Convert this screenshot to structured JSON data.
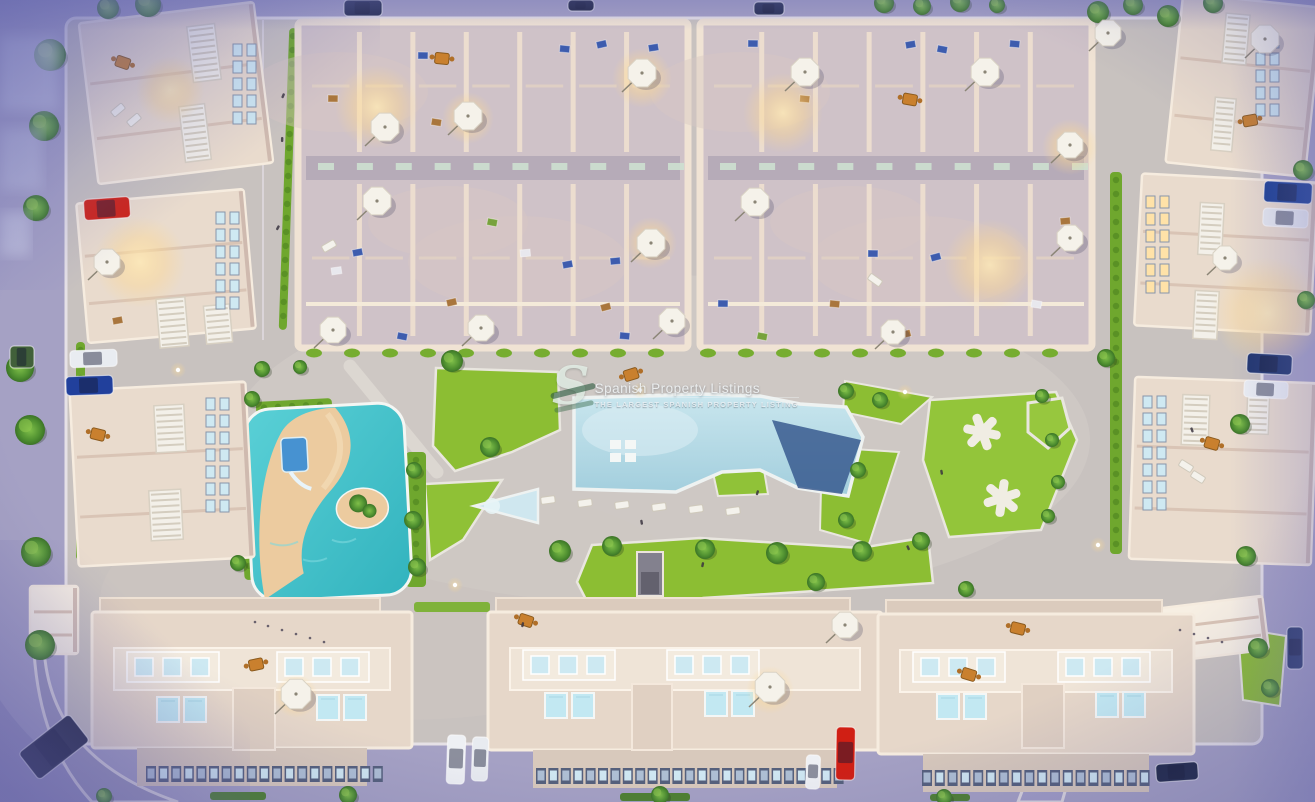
{
  "watermark": {
    "logo": "S",
    "title": "Spanish Property Listings",
    "subtitle": "THE LARGEST SPANISH PROPERTY LISTING"
  },
  "scene": {
    "description": "Aerial dusk render of a residential complex with central pool, lagoon splash park, lawns and perimeter apartment buildings",
    "palette": {
      "street": "#a5a1c4",
      "plaza": "#c8c2bf",
      "plazaLight": "#d4cec9",
      "wall": "#eadcce",
      "wallBright": "#f4e9db",
      "wallShadow": "#c8b2a8",
      "floor": "#cfc2c8",
      "corridor": "#b6abb8",
      "green": "#8cbe33",
      "greenLight": "#a8d44b",
      "hedge": "#6fa72e",
      "pool": "#b5dbe6",
      "poolDeep": "#31528a",
      "lagoon": "#4ac4cc",
      "sand": "#eccb9f",
      "plunge": "#c2e8f2",
      "glow": "#ffd98f",
      "umbrella": "#f5f2ea",
      "louver": "#f3f0e9",
      "carRed": "#cf2318",
      "carBlue": "#21409c",
      "carWhite": "#eceff3",
      "carDark": "#222a4c"
    },
    "trees": [
      [
        50,
        55,
        16
      ],
      [
        44,
        126,
        15
      ],
      [
        36,
        208,
        13
      ],
      [
        20,
        368,
        14
      ],
      [
        30,
        430,
        15
      ],
      [
        36,
        552,
        15
      ],
      [
        40,
        645,
        15
      ],
      [
        148,
        4,
        13
      ],
      [
        108,
        8,
        11
      ],
      [
        262,
        369,
        8
      ],
      [
        300,
        367,
        7
      ],
      [
        452,
        361,
        11
      ],
      [
        490,
        447,
        10
      ],
      [
        560,
        551,
        11
      ],
      [
        612,
        546,
        10
      ],
      [
        705,
        549,
        10
      ],
      [
        777,
        553,
        11
      ],
      [
        816,
        582,
        9
      ],
      [
        862,
        551,
        10
      ],
      [
        921,
        541,
        9
      ],
      [
        966,
        589,
        8
      ],
      [
        414,
        470,
        8
      ],
      [
        413,
        520,
        9
      ],
      [
        417,
        567,
        9
      ],
      [
        252,
        399,
        8
      ],
      [
        238,
        563,
        8
      ],
      [
        846,
        391,
        8
      ],
      [
        880,
        400,
        8
      ],
      [
        858,
        470,
        8
      ],
      [
        846,
        520,
        8
      ],
      [
        1042,
        396,
        7
      ],
      [
        1052,
        440,
        7
      ],
      [
        1058,
        482,
        7
      ],
      [
        1048,
        516,
        7
      ],
      [
        1106,
        358,
        9
      ],
      [
        1240,
        424,
        10
      ],
      [
        1246,
        556,
        10
      ],
      [
        1258,
        648,
        10
      ],
      [
        1270,
        688,
        9
      ],
      [
        884,
        3,
        10
      ],
      [
        922,
        6,
        9
      ],
      [
        960,
        2,
        10
      ],
      [
        997,
        5,
        8
      ],
      [
        1098,
        12,
        11
      ],
      [
        1133,
        5,
        10
      ],
      [
        1168,
        16,
        11
      ],
      [
        1213,
        3,
        10
      ],
      [
        1303,
        170,
        10
      ],
      [
        1306,
        300,
        9
      ],
      [
        348,
        795,
        9
      ],
      [
        660,
        795,
        9
      ],
      [
        944,
        797,
        8
      ],
      [
        104,
        796,
        8
      ]
    ],
    "cars": [
      {
        "x": 84,
        "y": 198,
        "w": 46,
        "h": 21,
        "rot": -4,
        "color": "#cf2318"
      },
      {
        "x": 70,
        "y": 350,
        "w": 47,
        "h": 17,
        "rot": -2,
        "color": "#e9ecf1"
      },
      {
        "x": 66,
        "y": 376,
        "w": 47,
        "h": 19,
        "rot": -2,
        "color": "#21409c"
      },
      {
        "x": 22,
        "y": 730,
        "w": 64,
        "h": 34,
        "rot": -38,
        "color": "#252a44"
      },
      {
        "x": 1264,
        "y": 182,
        "w": 48,
        "h": 21,
        "rot": 3,
        "color": "#1c3f93"
      },
      {
        "x": 1263,
        "y": 209,
        "w": 45,
        "h": 18,
        "rot": 3,
        "color": "#e6e9ee"
      },
      {
        "x": 1247,
        "y": 354,
        "w": 45,
        "h": 20,
        "rot": 3,
        "color": "#20356e"
      },
      {
        "x": 1244,
        "y": 381,
        "w": 44,
        "h": 17,
        "rot": 3,
        "color": "#eceff3"
      },
      {
        "x": 1287,
        "y": 627,
        "w": 16,
        "h": 42,
        "rot": 0,
        "color": "#2a3a6a"
      },
      {
        "x": 447,
        "y": 735,
        "w": 18,
        "h": 49,
        "rot": 2,
        "color": "#eef0f4"
      },
      {
        "x": 472,
        "y": 737,
        "w": 16,
        "h": 44,
        "rot": 2,
        "color": "#e8ebf0"
      },
      {
        "x": 836,
        "y": 727,
        "w": 19,
        "h": 53,
        "rot": 1,
        "color": "#d01f14"
      },
      {
        "x": 806,
        "y": 755,
        "w": 14,
        "h": 34,
        "rot": 2,
        "color": "#eef0f4"
      },
      {
        "x": 1156,
        "y": 763,
        "w": 42,
        "h": 18,
        "rot": -4,
        "color": "#1e2746"
      },
      {
        "x": 344,
        "y": 0,
        "w": 38,
        "h": 16,
        "rot": 0,
        "color": "#222a4c"
      },
      {
        "x": 568,
        "y": 0,
        "w": 26,
        "h": 11,
        "rot": 0,
        "color": "#1d2240"
      },
      {
        "x": 754,
        "y": 2,
        "w": 30,
        "h": 13,
        "rot": 0,
        "color": "#232b4e"
      },
      {
        "x": 10,
        "y": 346,
        "w": 24,
        "h": 22,
        "rot": 0,
        "color": "#41603a"
      }
    ],
    "umbrellas": [
      [
        385,
        127,
        15
      ],
      [
        468,
        116,
        15
      ],
      [
        642,
        73,
        15
      ],
      [
        377,
        201,
        15
      ],
      [
        651,
        243,
        15
      ],
      [
        333,
        330,
        14
      ],
      [
        481,
        328,
        14
      ],
      [
        672,
        321,
        14
      ],
      [
        805,
        72,
        15
      ],
      [
        985,
        72,
        15
      ],
      [
        755,
        202,
        15
      ],
      [
        1070,
        145,
        14
      ],
      [
        1070,
        238,
        14
      ],
      [
        893,
        332,
        13
      ],
      [
        107,
        262,
        14
      ],
      [
        1108,
        33,
        14
      ],
      [
        1265,
        39,
        15
      ],
      [
        1225,
        258,
        13
      ],
      [
        296,
        694,
        16
      ],
      [
        770,
        687,
        16
      ],
      [
        845,
        625,
        14
      ]
    ],
    "glows": [
      [
        377,
        107,
        42
      ],
      [
        783,
        113,
        40
      ],
      [
        642,
        78,
        30
      ],
      [
        990,
        265,
        46
      ],
      [
        1268,
        313,
        56
      ],
      [
        140,
        262,
        46
      ],
      [
        651,
        243,
        26
      ],
      [
        468,
        118,
        26
      ],
      [
        170,
        90,
        34
      ],
      [
        1070,
        147,
        28
      ],
      [
        770,
        690,
        24
      ],
      [
        296,
        696,
        22
      ]
    ],
    "lamps": [
      [
        178,
        370
      ],
      [
        455,
        585
      ],
      [
        905,
        392
      ],
      [
        1098,
        545
      ],
      [
        640,
        390
      ]
    ],
    "loungers": [
      [
        548,
        500,
        -8
      ],
      [
        585,
        503,
        -8
      ],
      [
        622,
        505,
        -8
      ],
      [
        659,
        507,
        -8
      ],
      [
        696,
        509,
        -8
      ],
      [
        733,
        511,
        -8
      ],
      [
        118,
        110,
        -40
      ],
      [
        134,
        120,
        -40
      ],
      [
        1186,
        466,
        32
      ],
      [
        1198,
        477,
        32
      ],
      [
        329,
        246,
        -30
      ],
      [
        875,
        280,
        35
      ]
    ],
    "tables": [
      [
        123,
        62
      ],
      [
        98,
        434
      ],
      [
        1212,
        443
      ],
      [
        1250,
        120
      ],
      [
        256,
        664
      ],
      [
        526,
        620
      ],
      [
        969,
        674
      ],
      [
        1018,
        628
      ],
      [
        910,
        99
      ],
      [
        442,
        58
      ],
      [
        631,
        374
      ]
    ],
    "furniture": [
      [
        418,
        52,
        "n"
      ],
      [
        560,
        45,
        "n"
      ],
      [
        596,
        42,
        "n"
      ],
      [
        648,
        45,
        "n"
      ],
      [
        328,
        95,
        "b"
      ],
      [
        432,
        118,
        "b"
      ],
      [
        520,
        250,
        "w"
      ],
      [
        562,
        262,
        "n"
      ],
      [
        610,
        258,
        "n"
      ],
      [
        352,
        250,
        "n"
      ],
      [
        331,
        268,
        "w"
      ],
      [
        446,
        300,
        "b"
      ],
      [
        600,
        305,
        "b"
      ],
      [
        398,
        332,
        "n"
      ],
      [
        620,
        332,
        "n"
      ],
      [
        748,
        40,
        "n"
      ],
      [
        800,
        95,
        "b"
      ],
      [
        905,
        42,
        "n"
      ],
      [
        938,
        45,
        "n"
      ],
      [
        868,
        250,
        "n"
      ],
      [
        930,
        255,
        "n"
      ],
      [
        830,
        300,
        "b"
      ],
      [
        900,
        332,
        "b"
      ],
      [
        1032,
        300,
        "w"
      ],
      [
        718,
        300,
        "n"
      ],
      [
        1010,
        40,
        "n"
      ],
      [
        1060,
        218,
        "b"
      ],
      [
        758,
        332,
        "g"
      ],
      [
        488,
        218,
        "g"
      ],
      [
        112,
        318,
        "b"
      ]
    ],
    "people": [
      [
        283,
        93
      ],
      [
        281,
        137
      ],
      [
        278,
        225
      ],
      [
        640,
        520
      ],
      [
        702,
        562
      ],
      [
        906,
        546
      ],
      [
        1190,
        428
      ],
      [
        522,
        622
      ],
      [
        940,
        470
      ],
      [
        757,
        490
      ]
    ],
    "scribbles": [
      [
        255,
        622
      ],
      [
        268,
        626
      ],
      [
        282,
        630
      ],
      [
        296,
        634
      ],
      [
        310,
        638
      ],
      [
        324,
        642
      ],
      [
        1180,
        630
      ],
      [
        1194,
        634
      ],
      [
        1208,
        638
      ],
      [
        1222,
        642
      ]
    ],
    "louverPanels": [
      [
        190,
        25,
        28,
        56,
        -7
      ],
      [
        182,
        105,
        26,
        56,
        -7
      ],
      [
        158,
        298,
        29,
        49,
        -5
      ],
      [
        205,
        305,
        26,
        38,
        -5
      ],
      [
        155,
        405,
        30,
        47,
        -3
      ],
      [
        150,
        490,
        32,
        50,
        -3
      ],
      [
        1224,
        14,
        24,
        50,
        5
      ],
      [
        1213,
        98,
        21,
        53,
        5
      ],
      [
        1199,
        203,
        24,
        52,
        3
      ],
      [
        1194,
        291,
        24,
        48,
        3
      ],
      [
        1182,
        395,
        27,
        50,
        2
      ],
      [
        1247,
        390,
        22,
        44,
        2
      ]
    ],
    "buildings": [
      {
        "x": 88,
        "y": 12,
        "w": 176,
        "h": 162,
        "rot": -7,
        "bright": false
      },
      {
        "x": 82,
        "y": 196,
        "w": 168,
        "h": 140,
        "rot": -5,
        "bright": false
      },
      {
        "x": 74,
        "y": 386,
        "w": 176,
        "h": 176,
        "rot": -3,
        "bright": false
      },
      {
        "x": 1174,
        "y": 0,
        "w": 140,
        "h": 170,
        "rot": 6,
        "bright": false
      },
      {
        "x": 1138,
        "y": 178,
        "w": 176,
        "h": 152,
        "rot": 3,
        "bright": false
      },
      {
        "x": 1132,
        "y": 380,
        "w": 182,
        "h": 182,
        "rot": 2,
        "bright": false
      },
      {
        "x": 30,
        "y": 586,
        "w": 48,
        "h": 68,
        "rot": 0,
        "bright": true
      },
      {
        "x": 1128,
        "y": 604,
        "w": 138,
        "h": 54,
        "rot": -7,
        "bright": true
      }
    ],
    "windowGrids": [
      {
        "x": 216,
        "y": 212,
        "cols": 2,
        "rows": 6,
        "lit": false
      },
      {
        "x": 206,
        "y": 398,
        "cols": 2,
        "rows": 7,
        "lit": false
      },
      {
        "x": 1146,
        "y": 196,
        "cols": 2,
        "rows": 6,
        "lit": true
      },
      {
        "x": 1143,
        "y": 396,
        "cols": 2,
        "rows": 7,
        "lit": false
      },
      {
        "x": 233,
        "y": 44,
        "cols": 2,
        "rows": 5,
        "lit": false
      },
      {
        "x": 1256,
        "y": 36,
        "cols": 2,
        "rows": 5,
        "lit": false
      }
    ],
    "blocks": [
      {
        "x": 298,
        "y": 22,
        "w": 390,
        "h": 326,
        "cols": 7
      },
      {
        "x": 700,
        "y": 22,
        "w": 392,
        "h": 326,
        "cols": 7
      }
    ],
    "bottomBuildings": [
      {
        "x": 92,
        "y": 612,
        "w": 320,
        "h": 136,
        "pools": [
          [
            157,
            697
          ],
          [
            184,
            697
          ],
          [
            317,
            695
          ],
          [
            344,
            695
          ]
        ],
        "shaft": [
          233,
          688,
          42,
          62
        ],
        "winRow": {
          "x": 146,
          "y": 766,
          "n": 19,
          "dx": 12.6
        },
        "terr": [
          [
            127,
            652
          ],
          [
            277,
            652
          ]
        ]
      },
      {
        "x": 488,
        "y": 612,
        "w": 394,
        "h": 138,
        "pools": [
          [
            545,
            693
          ],
          [
            572,
            693
          ],
          [
            705,
            691
          ],
          [
            732,
            691
          ]
        ],
        "shaft": [
          632,
          684,
          40,
          66
        ],
        "winRow": {
          "x": 536,
          "y": 768,
          "n": 25,
          "dx": 12.4
        },
        "terr": [
          [
            523,
            650
          ],
          [
            667,
            650
          ]
        ]
      },
      {
        "x": 878,
        "y": 614,
        "w": 316,
        "h": 140,
        "pools": [
          [
            937,
            694
          ],
          [
            964,
            694
          ],
          [
            1096,
            692
          ],
          [
            1123,
            692
          ]
        ],
        "shaft": [
          1022,
          684,
          42,
          64
        ],
        "winRow": {
          "x": 922,
          "y": 770,
          "n": 18,
          "dx": 12.8
        },
        "terr": [
          [
            913,
            652
          ],
          [
            1058,
            652
          ]
        ]
      }
    ],
    "xstructs": [
      {
        "x": 982,
        "y": 432,
        "rot": 12
      },
      {
        "x": 1002,
        "y": 498,
        "rot": 40
      }
    ],
    "hedgeStrips": [
      [
        240,
        404,
        10,
        176,
        -3
      ],
      [
        406,
        452,
        20,
        135,
        0
      ],
      [
        1110,
        172,
        12,
        382,
        0
      ],
      [
        76,
        342,
        9,
        218,
        0
      ],
      [
        284,
        28,
        8,
        302,
        2
      ],
      [
        256,
        400,
        76,
        12,
        -3
      ]
    ],
    "roofGardens": [
      [
        168,
        600,
        158,
        12
      ],
      [
        414,
        602,
        76,
        10
      ],
      [
        688,
        600,
        100,
        11
      ],
      [
        800,
        602,
        46,
        9
      ],
      [
        908,
        600,
        76,
        11
      ],
      [
        1028,
        602,
        50,
        11
      ]
    ],
    "frontHedges": [
      [
        210,
        792,
        56,
        8
      ],
      [
        620,
        793,
        70,
        8
      ],
      [
        930,
        794,
        40,
        7
      ]
    ],
    "bushRows": [
      {
        "y": 353,
        "x0": 314,
        "x1": 666,
        "step": 38
      },
      {
        "y": 353,
        "x0": 708,
        "x1": 1084,
        "step": 38
      }
    ]
  }
}
